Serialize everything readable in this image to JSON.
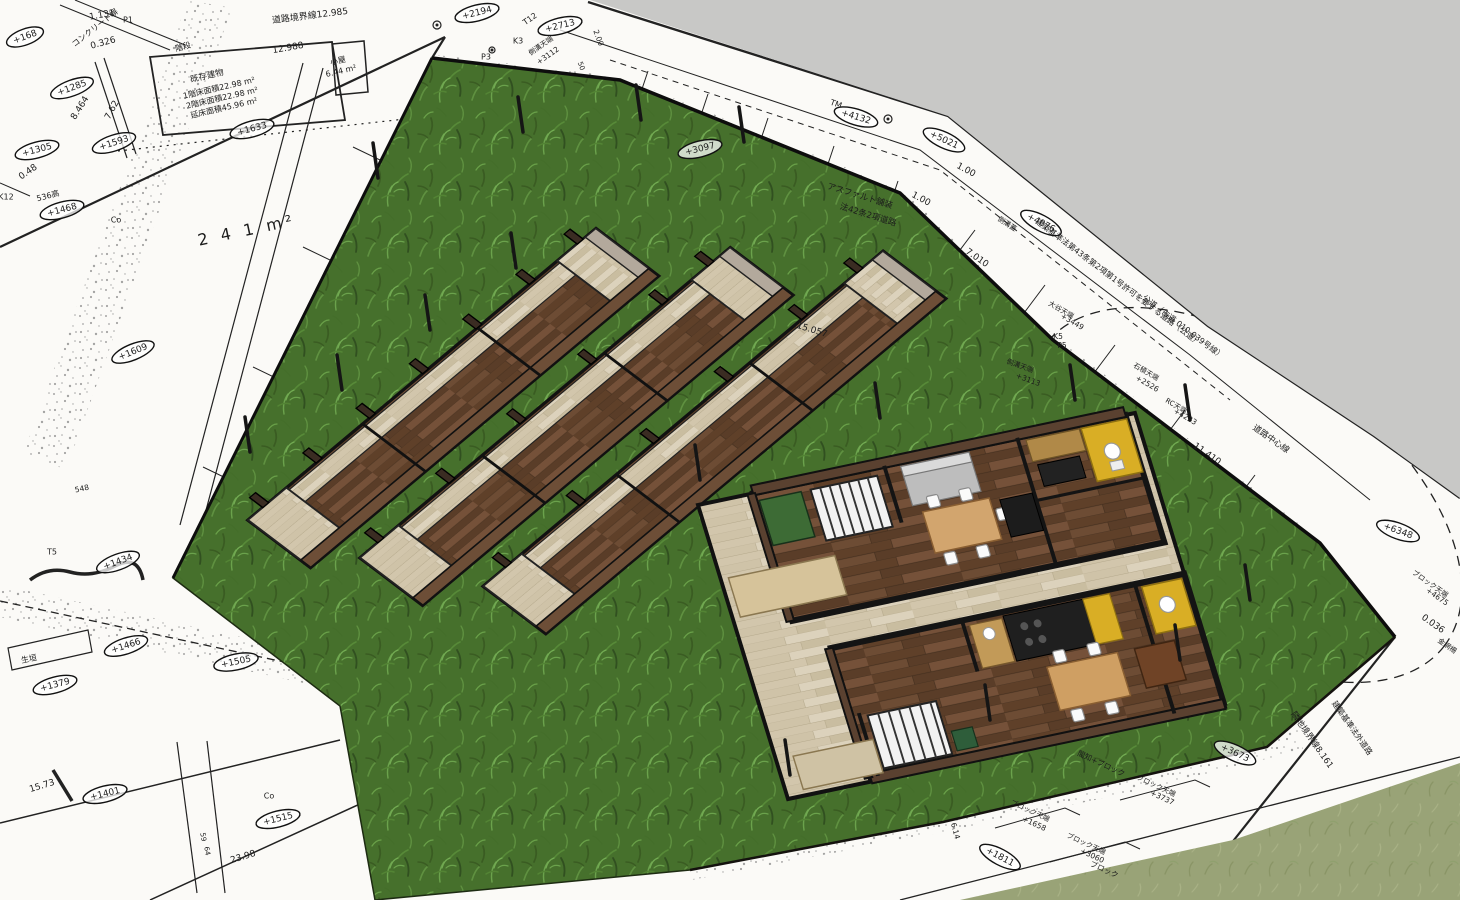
{
  "view": {
    "type": "3d-site-model-viewport",
    "colors": {
      "sky_gray": "#c8c8c6",
      "paper_white": "#fbfaf7",
      "site_grass": "#46702c",
      "neighbor_grass": "#99a377",
      "ink": "#1c1c1c",
      "floor_dark_wood": "#6b4a33",
      "deck_pale_wood": "#d5cab2",
      "kitchen_yellow": "#d9ae25",
      "wall_brown": "#5a4130"
    }
  },
  "annotations": [
    {
      "t": "コンクリート塀",
      "x": 95,
      "y": 28,
      "r": -38,
      "s": 8
    },
    {
      "t": "1.131",
      "x": 102,
      "y": 15,
      "r": -10
    },
    {
      "t": "P1",
      "x": 128,
      "y": 20,
      "r": 0,
      "s": 8
    },
    {
      "t": "0.326",
      "x": 103,
      "y": 43,
      "r": -15
    },
    {
      "t": "+168",
      "x": 25,
      "y": 37,
      "r": -20,
      "e": 1
    },
    {
      "t": "+1285",
      "x": 72,
      "y": 88,
      "r": -20,
      "e": 1
    },
    {
      "t": "8.464",
      "x": 80,
      "y": 108,
      "r": -58
    },
    {
      "t": "7.62",
      "x": 112,
      "y": 110,
      "r": -62
    },
    {
      "t": "+1305",
      "x": 37,
      "y": 150,
      "r": -15,
      "e": 1
    },
    {
      "t": "0.48",
      "x": 28,
      "y": 172,
      "r": -35
    },
    {
      "t": "K12",
      "x": 6,
      "y": 197,
      "r": 0,
      "s": 8
    },
    {
      "t": "536高",
      "x": 48,
      "y": 196,
      "r": -15,
      "s": 8
    },
    {
      "t": "+1468",
      "x": 62,
      "y": 210,
      "r": -15,
      "e": 1
    },
    {
      "t": "+1593",
      "x": 114,
      "y": 143,
      "r": -18,
      "e": 1
    },
    {
      "t": "+1633",
      "x": 252,
      "y": 129,
      "r": -15,
      "e": 1
    },
    {
      "t": "道路境界線12.985",
      "x": 310,
      "y": 16,
      "r": -7
    },
    {
      "t": "階段",
      "x": 183,
      "y": 47,
      "r": -15,
      "s": 8
    },
    {
      "t": "既存建物",
      "x": 207,
      "y": 76,
      "r": -13,
      "s": 8.5
    },
    {
      "t": "1階床面積22.98 m²",
      "x": 219,
      "y": 88,
      "r": -13,
      "s": 8
    },
    {
      "t": "2階床面積22.98 m²",
      "x": 222,
      "y": 98,
      "r": -13,
      "s": 8
    },
    {
      "t": "延床面積45.96 m²",
      "x": 224,
      "y": 108,
      "r": -13,
      "s": 8
    },
    {
      "t": "12.988",
      "x": 288,
      "y": 48,
      "r": -10
    },
    {
      "t": "小屋",
      "x": 338,
      "y": 61,
      "r": -13,
      "s": 8
    },
    {
      "t": "6.44 m²",
      "x": 341,
      "y": 71,
      "r": -13,
      "s": 8
    },
    {
      "t": "2 4 1 m²",
      "x": 247,
      "y": 231,
      "r": -12,
      "s": 16,
      "sp": 4
    },
    {
      "t": "Co",
      "x": 116,
      "y": 220,
      "r": 0,
      "s": 8
    },
    {
      "t": "+1609",
      "x": 133,
      "y": 352,
      "r": -22,
      "e": 1
    },
    {
      "t": "548",
      "x": 82,
      "y": 489,
      "r": -12,
      "s": 7.5
    },
    {
      "t": "T5",
      "x": 52,
      "y": 552,
      "r": 0,
      "s": 8
    },
    {
      "t": "+1434",
      "x": 118,
      "y": 562,
      "r": -20,
      "e": 1
    },
    {
      "t": "+1466",
      "x": 126,
      "y": 646,
      "r": -18,
      "e": 1
    },
    {
      "t": "+1505",
      "x": 236,
      "y": 662,
      "r": -12,
      "e": 1
    },
    {
      "t": "+1379",
      "x": 55,
      "y": 685,
      "r": -15,
      "e": 1
    },
    {
      "t": "生垣",
      "x": 29,
      "y": 659,
      "r": -12,
      "s": 8
    },
    {
      "t": "15.73",
      "x": 42,
      "y": 786,
      "r": -17
    },
    {
      "t": "+1401",
      "x": 105,
      "y": 794,
      "r": -14,
      "e": 1
    },
    {
      "t": "Co",
      "x": 269,
      "y": 796,
      "r": 0,
      "s": 8
    },
    {
      "t": "+1515",
      "x": 278,
      "y": 819,
      "r": -14,
      "e": 1
    },
    {
      "t": "23.98",
      "x": 243,
      "y": 857,
      "r": -17
    },
    {
      "t": "59",
      "x": 203,
      "y": 837,
      "r": 80,
      "s": 7
    },
    {
      "t": "64",
      "x": 207,
      "y": 851,
      "r": 80,
      "s": 7
    },
    {
      "t": "+2194",
      "x": 477,
      "y": 13,
      "r": -14,
      "e": 1
    },
    {
      "t": "T12",
      "x": 530,
      "y": 19,
      "r": -35,
      "s": 8
    },
    {
      "t": "+2713",
      "x": 560,
      "y": 26,
      "r": -14,
      "e": 1
    },
    {
      "t": "K3",
      "x": 518,
      "y": 41,
      "r": 0,
      "s": 8
    },
    {
      "t": "側溝天端",
      "x": 541,
      "y": 46,
      "r": -35,
      "s": 7
    },
    {
      "t": "+3112",
      "x": 548,
      "y": 56,
      "r": -35,
      "s": 7.5
    },
    {
      "t": "P3",
      "x": 486,
      "y": 57,
      "r": 0,
      "s": 8
    },
    {
      "t": "2.00",
      "x": 598,
      "y": 38,
      "r": 70,
      "s": 7.5
    },
    {
      "t": "50",
      "x": 581,
      "y": 66,
      "r": 70,
      "s": 7
    },
    {
      "t": "+3097",
      "x": 700,
      "y": 149,
      "r": -14,
      "e": 1
    },
    {
      "t": "アスファルト舗装",
      "x": 860,
      "y": 196,
      "r": 17,
      "s": 8.5
    },
    {
      "t": "法42条2項道路",
      "x": 868,
      "y": 215,
      "r": 17,
      "s": 8.5
    },
    {
      "t": "15.057",
      "x": 812,
      "y": 330,
      "r": 17
    },
    {
      "t": "側溝天端",
      "x": 1020,
      "y": 366,
      "r": 20,
      "s": 7
    },
    {
      "t": "+3113",
      "x": 1028,
      "y": 380,
      "r": 20,
      "s": 7.5
    },
    {
      "t": "TM",
      "x": 836,
      "y": 104,
      "r": 20,
      "s": 8
    },
    {
      "t": "+4132",
      "x": 856,
      "y": 117,
      "r": 17,
      "e": 1
    },
    {
      "t": "+5021",
      "x": 944,
      "y": 140,
      "r": 25,
      "e": 1
    },
    {
      "t": "1.00",
      "x": 966,
      "y": 170,
      "r": 28
    },
    {
      "t": "1.00",
      "x": 921,
      "y": 199,
      "r": 28
    },
    {
      "t": "7.010",
      "x": 977,
      "y": 258,
      "r": 35
    },
    {
      "t": "側溝蓋",
      "x": 1007,
      "y": 224,
      "r": 33,
      "s": 7
    },
    {
      "t": "+4076",
      "x": 1041,
      "y": 223,
      "r": 28,
      "e": 1
    },
    {
      "t": "建築基準法第43条第2項第1号許可を要する道路（公道）",
      "x": 1118,
      "y": 282,
      "r": 37,
      "s": 8
    },
    {
      "t": "公道（市道 010-039号線）",
      "x": 1183,
      "y": 327,
      "r": 37,
      "s": 8
    },
    {
      "t": "大谷天端",
      "x": 1061,
      "y": 310,
      "r": 30,
      "s": 7
    },
    {
      "t": "+3449",
      "x": 1072,
      "y": 322,
      "r": 30,
      "s": 7.5
    },
    {
      "t": "K5",
      "x": 1058,
      "y": 337,
      "r": 0,
      "s": 7.5
    },
    {
      "t": "P5",
      "x": 1062,
      "y": 346,
      "r": 0,
      "s": 7.5
    },
    {
      "t": "石積天端",
      "x": 1146,
      "y": 372,
      "r": 30,
      "s": 7
    },
    {
      "t": "+2526",
      "x": 1147,
      "y": 384,
      "r": 30,
      "s": 7.5
    },
    {
      "t": "RC天端",
      "x": 1176,
      "y": 406,
      "r": 30,
      "s": 7
    },
    {
      "t": "+4223",
      "x": 1185,
      "y": 417,
      "r": 30,
      "s": 7.5
    },
    {
      "t": "11.410",
      "x": 1207,
      "y": 454,
      "r": 35
    },
    {
      "t": "道路中心線",
      "x": 1271,
      "y": 439,
      "r": 35,
      "s": 8.5
    },
    {
      "t": "+6348",
      "x": 1398,
      "y": 531,
      "r": 20,
      "e": 1
    },
    {
      "t": "ブロック天端",
      "x": 1430,
      "y": 584,
      "r": 35,
      "s": 7
    },
    {
      "t": "+4675",
      "x": 1437,
      "y": 597,
      "r": 35,
      "s": 7.5
    },
    {
      "t": "0.036",
      "x": 1433,
      "y": 624,
      "r": 35
    },
    {
      "t": "金網柵",
      "x": 1447,
      "y": 646,
      "r": 35,
      "s": 7
    },
    {
      "t": "隣地境界線8.161",
      "x": 1312,
      "y": 740,
      "r": 55,
      "s": 8.5
    },
    {
      "t": "建築基準法外道路",
      "x": 1352,
      "y": 728,
      "r": 55,
      "s": 8
    },
    {
      "t": "+3673",
      "x": 1235,
      "y": 753,
      "r": 25,
      "e": 1
    },
    {
      "t": "間知+ブロック",
      "x": 1101,
      "y": 764,
      "r": 25,
      "s": 7.5
    },
    {
      "t": "ブロック天端",
      "x": 1156,
      "y": 786,
      "r": 25,
      "s": 7
    },
    {
      "t": "+3737",
      "x": 1162,
      "y": 798,
      "r": 25,
      "s": 7.5
    },
    {
      "t": "ブロック天端",
      "x": 1030,
      "y": 811,
      "r": 25,
      "s": 7
    },
    {
      "t": "+1658",
      "x": 1034,
      "y": 824,
      "r": 25,
      "s": 7.5
    },
    {
      "t": "ブロック天端",
      "x": 1086,
      "y": 844,
      "r": 25,
      "s": 7
    },
    {
      "t": "+3060",
      "x": 1092,
      "y": 856,
      "r": 25,
      "s": 7.5
    },
    {
      "t": "ブロック",
      "x": 1104,
      "y": 870,
      "r": 25,
      "s": 7.5
    },
    {
      "t": "+1811",
      "x": 1000,
      "y": 857,
      "r": 28,
      "e": 1
    },
    {
      "t": "6.14",
      "x": 955,
      "y": 831,
      "r": 75,
      "s": 7.5
    }
  ]
}
